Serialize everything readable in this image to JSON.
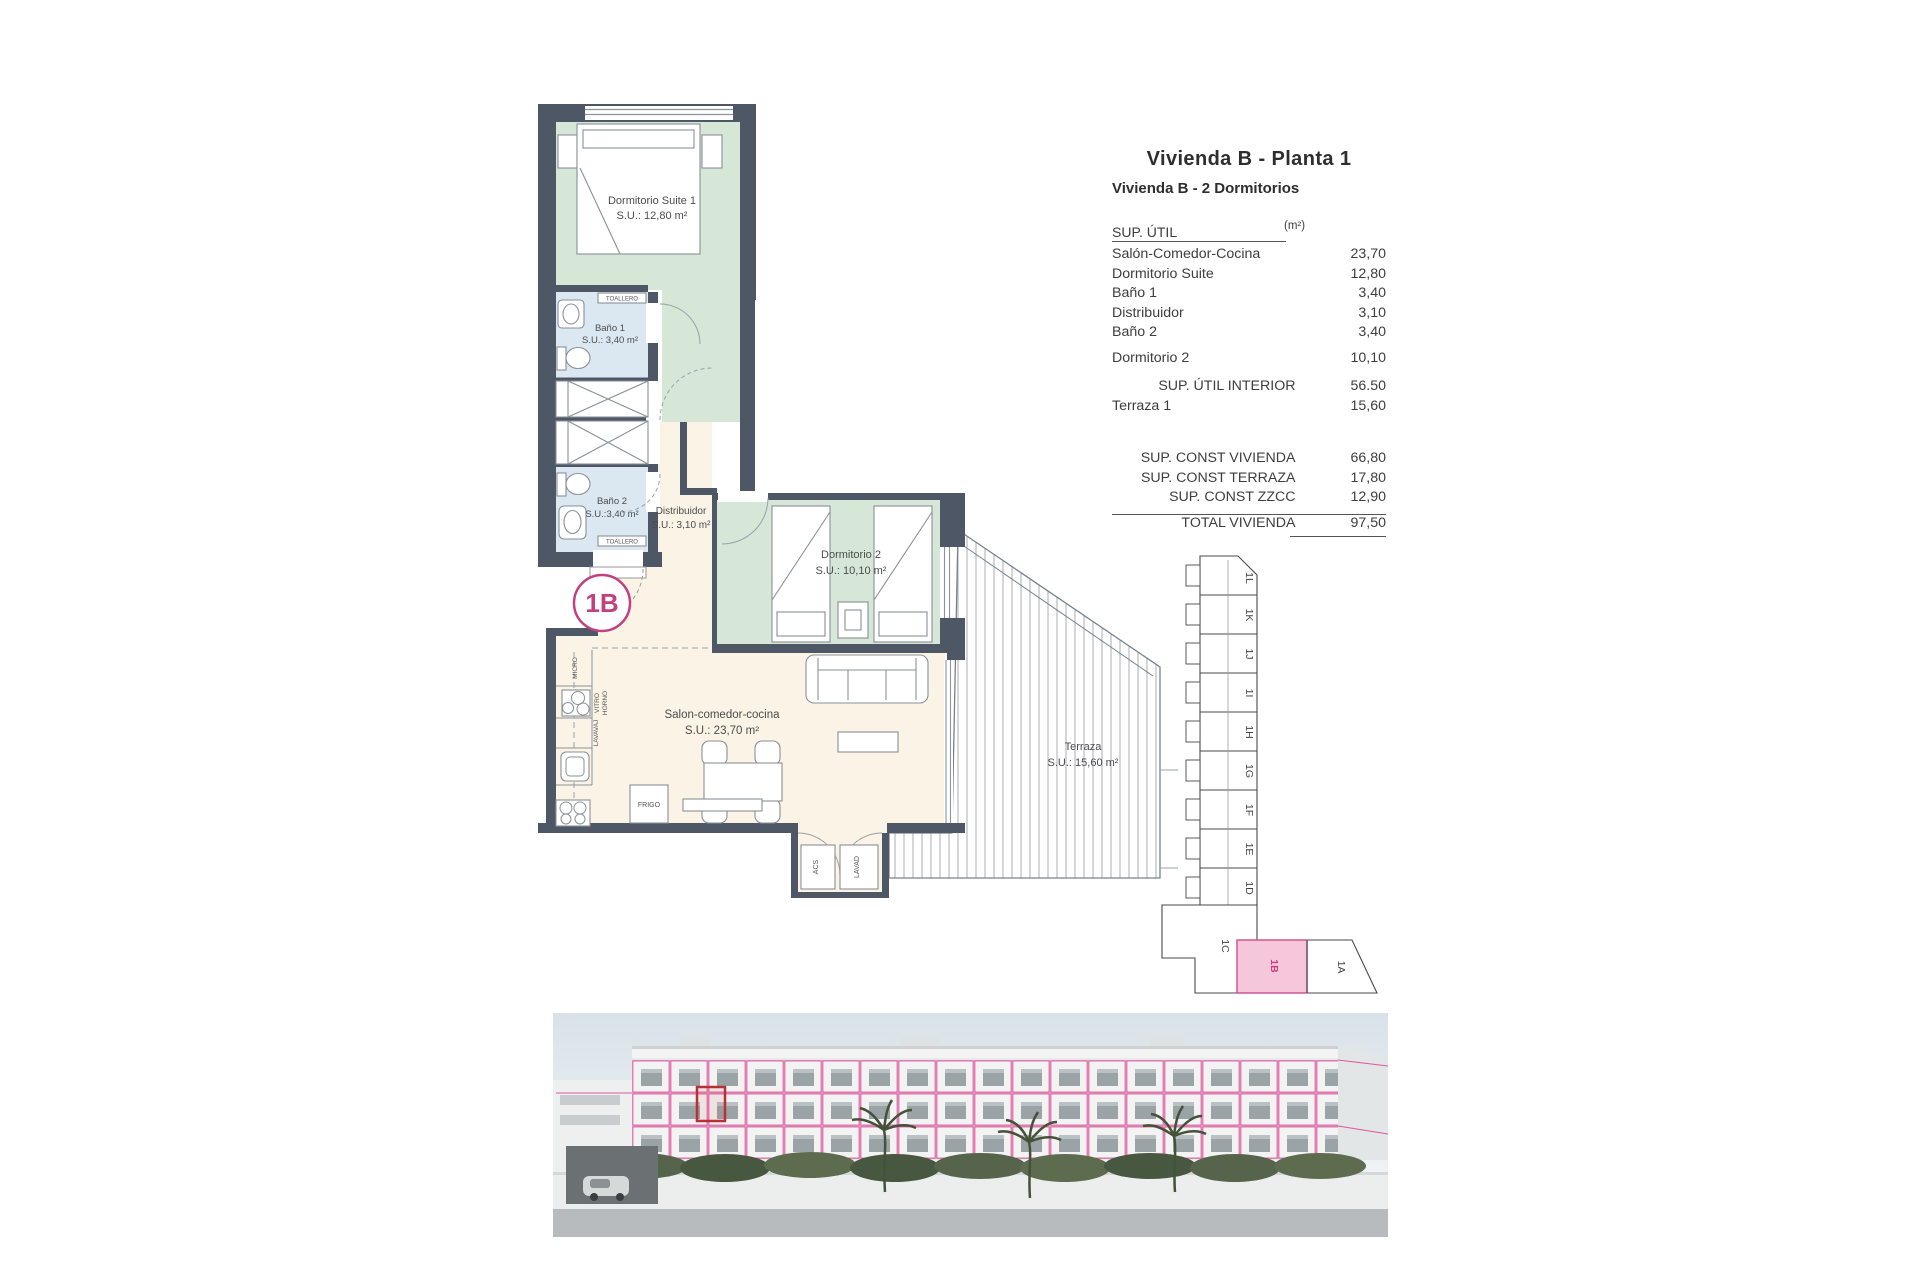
{
  "sheet": {
    "title": "Vivienda B - Planta 1",
    "subtitle": "Vivienda B - 2 Dormitorios"
  },
  "area_table": {
    "header": {
      "label": "SUP. ÚTIL",
      "unit": "(m²)"
    },
    "rows": [
      {
        "label": "Salón-Comedor-Cocina",
        "value": "23,70"
      },
      {
        "label": "Dormitorio Suite",
        "value": "12,80"
      },
      {
        "label": "Baño 1",
        "value": "3,40"
      },
      {
        "label": "Distribuidor",
        "value": "3,10"
      },
      {
        "label": "Baño 2",
        "value": "3,40"
      },
      {
        "label": "Dormitorio 2",
        "value": "10,10"
      }
    ],
    "subtotal": {
      "label": "SUP. ÚTIL INTERIOR",
      "value": "56.50"
    },
    "terraza": {
      "label": "Terraza 1",
      "value": "15,60"
    },
    "const_rows": [
      {
        "label": "SUP. CONST VIVIENDA",
        "value": "66,80"
      },
      {
        "label": "SUP. CONST TERRAZA",
        "value": "17,80"
      },
      {
        "label": "SUP. CONST ZZCC",
        "value": "12,90"
      }
    ],
    "total": {
      "label": "TOTAL VIVIENDA",
      "value": "97,50"
    }
  },
  "floor_plan": {
    "badge": "1B",
    "rooms": {
      "suite": {
        "name": "Dormitorio Suite 1",
        "area": "S.U.: 12,80 m²"
      },
      "bano1": {
        "name": "Baño 1",
        "area": "S.U.: 3,40 m²"
      },
      "bano2": {
        "name": "Baño 2",
        "area": "S.U.:3,40 m²"
      },
      "distribuidor": {
        "name": "Distribuidor",
        "area": "S.U.: 3,10 m²"
      },
      "dorm2": {
        "name": "Dormitorio 2",
        "area": "S.U.: 10,10 m²"
      },
      "salon": {
        "name": "Salon-comedor-cocina",
        "area": "S.U.: 23,70 m²"
      },
      "terraza": {
        "name": "Terraza",
        "area": "S.U.: 15,60 m²"
      }
    },
    "fixtures": {
      "toallero": "TOALLERO",
      "micro": "MICRO",
      "vitro": "VITRO",
      "horno": "HORNO",
      "lavavaj": "LAVAVAJ",
      "frigo": "FRIGO",
      "acs": "ACS",
      "lavad": "LAVAD"
    }
  },
  "key_plan": {
    "units": [
      "1L",
      "1K",
      "1J",
      "1I",
      "1H",
      "1G",
      "1F",
      "1E",
      "1D",
      "1C",
      "1B",
      "1A"
    ],
    "highlighted": "1B"
  },
  "palette": {
    "wall": "#4d5765",
    "bedroom_fill": "#d6e7d8",
    "bath_fill": "#dbe8f2",
    "living_fill": "#faf3e6",
    "accent_pink": "#c2407e",
    "keyplan_highlight": "#f6c6da",
    "render_outline_pink": "#e0569c",
    "render_highlight_red": "#b63036"
  }
}
